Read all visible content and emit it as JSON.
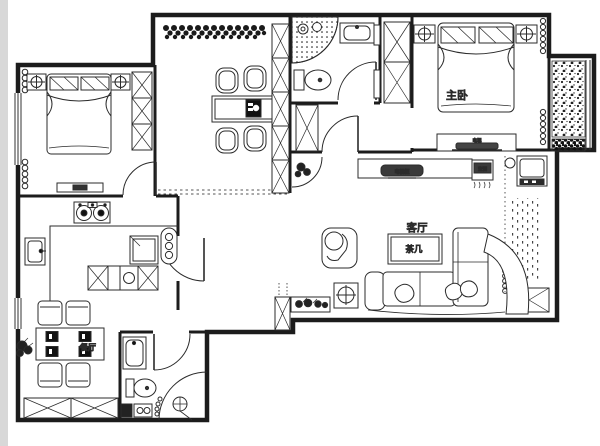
{
  "page": {
    "type": "apartment-floor-plan",
    "background": "#ffffff",
    "edge_strip_color": "#d8d8d8",
    "wall_color": "#1c1c1c",
    "label_color": "#999999"
  },
  "labels": {
    "master_bedroom": "主卧",
    "living_room": "客厅",
    "tea_table": "茶几",
    "tv_cabinet": "电视柜",
    "bedroom_tv": "电视",
    "ac_unit": "空调",
    "dining_room": "餐厅"
  },
  "rooms": [
    "second-bedroom",
    "study-room",
    "bathroom-top",
    "master-bedroom",
    "balcony",
    "living-room",
    "hallway",
    "kitchen",
    "dining-room",
    "bathroom-bottom"
  ],
  "furniture_icons": [
    "double-bed",
    "pillow",
    "nightstand-lamp",
    "wardrobe",
    "dresser",
    "curtain-coil",
    "window",
    "study-table",
    "study-chair",
    "flower-bed",
    "storage-cabinet",
    "corner-shower",
    "shower-head",
    "toilet",
    "wash-basin",
    "sliding-closet",
    "entry-door",
    "tv-cabinet",
    "tv",
    "air-conditioner",
    "washing-machine",
    "column",
    "bead-curtain",
    "sofa",
    "throw-pillow",
    "armchair",
    "tea-table",
    "side-table",
    "planter",
    "potted-plant",
    "dining-table",
    "dining-chair",
    "gas-stove",
    "kitchen-sink",
    "fridge",
    "radiator",
    "kitchen-counter",
    "bathtub",
    "shower-curtain",
    "pebble-floor"
  ]
}
